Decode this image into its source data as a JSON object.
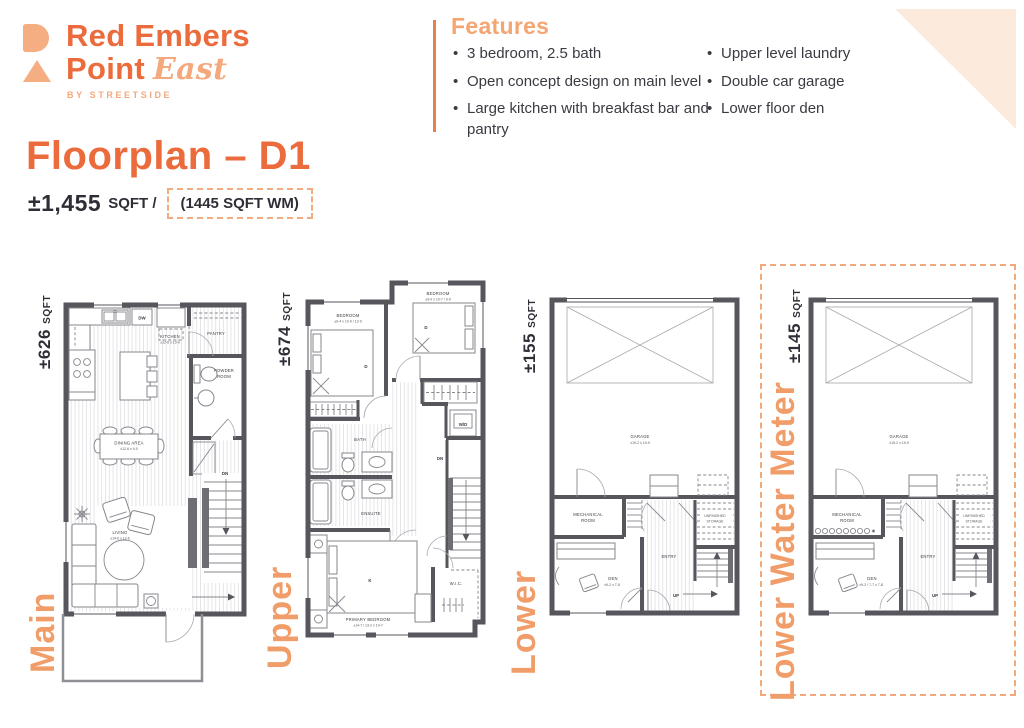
{
  "brand": {
    "name_top": "Red Embers",
    "name_bottom": "Point",
    "name_script": "East",
    "byline": "BY STREETSIDE"
  },
  "header": {
    "title": "Floorplan – D1",
    "total_area": "±1,455",
    "total_area_unit": "SQFT /",
    "wm_area": "(1445 SQFT WM)"
  },
  "features": {
    "title": "Features",
    "column1": [
      "3 bedroom, 2.5 bath",
      "Open concept design on main level",
      "Large kitchen with breakfast bar and pantry"
    ],
    "column2": [
      "Upper level laundry",
      "Double car garage",
      "Lower floor den"
    ]
  },
  "plans": {
    "main": {
      "name": "Main",
      "area": "±626",
      "area_unit": "SQFT",
      "labels": {
        "kitchen": "KITCHEN",
        "kitchen_dim": "±12-6 x 10-0",
        "dw": "DW",
        "pantry": "PANTRY",
        "powder_1": "POWDER",
        "powder_2": "ROOM",
        "dining": "DINING AREA",
        "dining_dim": "±12-6 x 9-0",
        "living": "LIVING",
        "living_dim": "±14-6 x 12-6",
        "dn": "DN"
      }
    },
    "upper": {
      "name": "Upper",
      "area": "±674",
      "area_unit": "SQFT",
      "labels": {
        "bedroom_left": "BEDROOM",
        "bedroom_left_dim": "±9-4 x 10-0 / 12-0",
        "bedroom_right": "BEDROOM",
        "bedroom_right_dim": "±9-0 x 10-7 / 9-9",
        "bed_double_left": "D",
        "bed_double_right": "D",
        "bath": "BATH",
        "ensuite": "ENSUITE",
        "washer_dryer": "W/D",
        "down": "DN",
        "primary": "PRIMARY BEDROOM",
        "primary_dim": "±14-7 / 13-2 x 10-7",
        "bed_king": "K",
        "wic": "W.I.C."
      }
    },
    "lower": {
      "name": "Lower",
      "area": "±155",
      "area_unit": "SQFT",
      "labels": {
        "garage": "GARAGE",
        "garage_dim": "±19-2 x 19-9",
        "mechanical_1": "MECHANICAL",
        "mechanical_2": "ROOM",
        "den": "DEN",
        "den_dim": "±9-2 x 7-8",
        "entry": "ENTRY",
        "storage_1": "UNFINISHED",
        "storage_2": "STORAGE",
        "up": "UP"
      }
    },
    "lower_wm": {
      "name": "Lower Water Meter",
      "area": "±145",
      "area_unit": "SQFT",
      "labels": {
        "garage": "GARAGE",
        "garage_dim": "±19-2 x 19-9",
        "mechanical_1": "MECHANICAL",
        "mechanical_2": "ROOM",
        "den": "DEN",
        "den_dim": "±9-2 / 7-7 x 7-8",
        "entry": "ENTRY",
        "storage_1": "UNFINISHED",
        "storage_2": "STORAGE",
        "up": "UP"
      }
    }
  },
  "colors": {
    "accent": "#EB6B3C",
    "peach": "#F4A87C",
    "plan_label_orange": "#F19D69",
    "divider": "#E5814B",
    "corner_triangle": "#FCEBDC",
    "wall": "#56565C",
    "text_dark": "#2E2E36"
  }
}
